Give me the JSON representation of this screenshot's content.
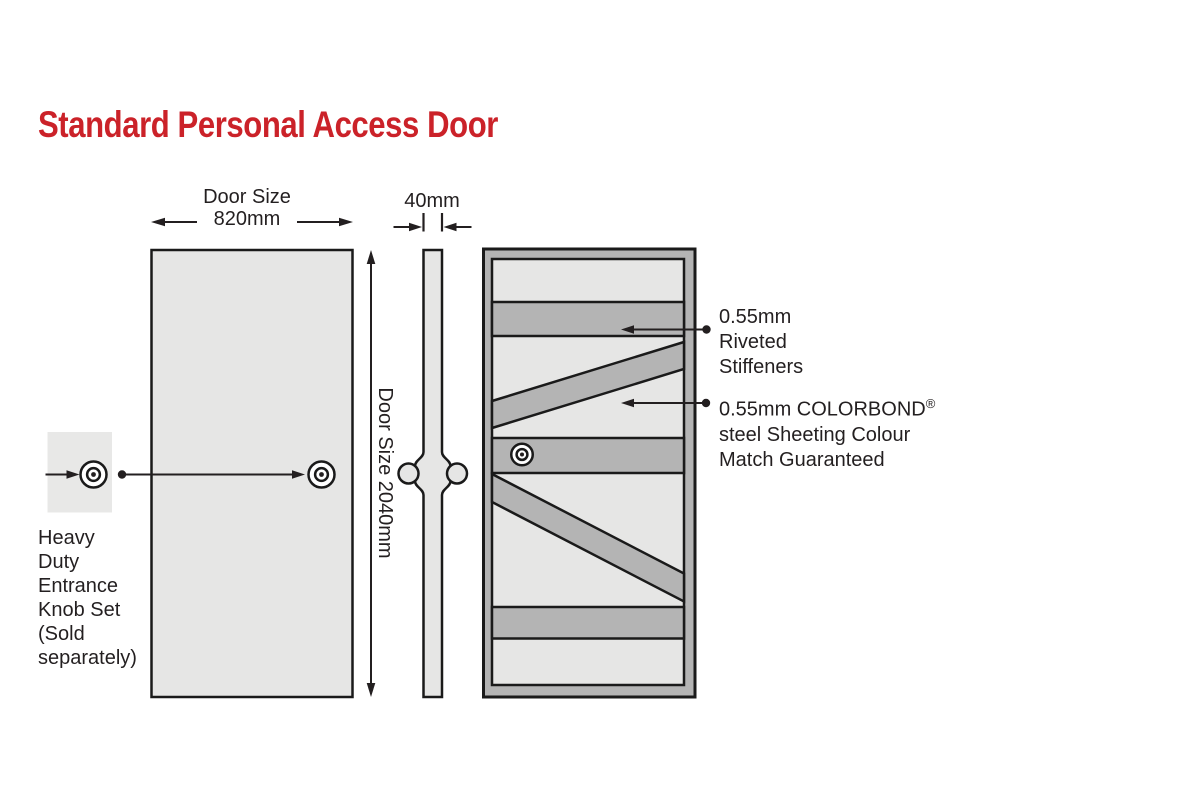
{
  "title": "Standard Personal Access Door",
  "colors": {
    "title_red": "#cb2229",
    "door_panel_light": "#e6e6e5",
    "stiffener_gray": "#b4b4b4",
    "knob_square_gray": "#e8e8e7",
    "line_black": "#231f20"
  },
  "front_view": {
    "width_label": "Door Size",
    "width_value": "820mm",
    "height_label": "Door Size 2040mm"
  },
  "side_view": {
    "thickness_value": "40mm"
  },
  "knob_annotation": {
    "lines": [
      "Heavy",
      "Duty",
      "Entrance",
      "Knob Set",
      "(Sold",
      "separately)"
    ]
  },
  "back_view_annotations": {
    "stiffeners": {
      "lines": [
        "0.55mm",
        "Riveted",
        "Stiffeners"
      ]
    },
    "sheeting": {
      "line1": "0.55mm COLORBOND",
      "line1_sup": "®",
      "line2": "steel Sheeting Colour",
      "line3": "Match Guaranteed"
    }
  }
}
